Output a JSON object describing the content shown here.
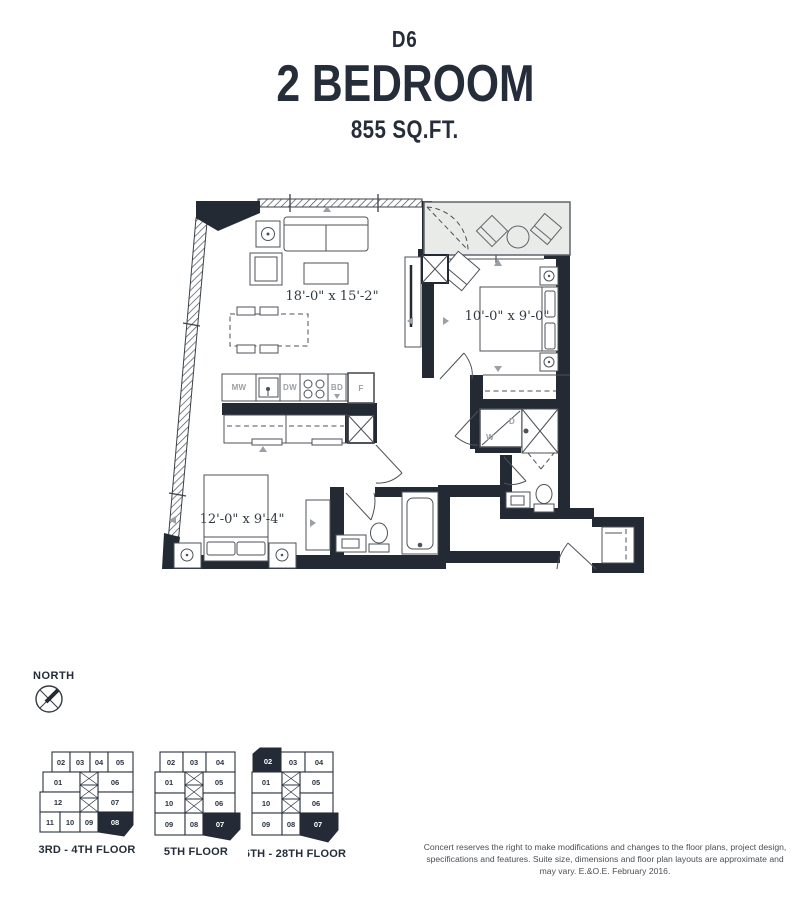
{
  "header": {
    "unit_code": "D6",
    "unit_type": "2 BEDROOM",
    "unit_size": "855 SQ.FT."
  },
  "floorplan": {
    "living_dim": "18'-0\" x 15'-2\"",
    "bedroom2_dim": "10'-0\" x 9'-0\"",
    "master_dim": "12'-0\" x 9'-4\"",
    "labels": {
      "microwave": "MW",
      "dishwasher": "DW",
      "burners": "BD",
      "fridge": "F",
      "washer": "W",
      "dryer": "D"
    }
  },
  "north": {
    "label": "NORTH"
  },
  "keyplans": [
    {
      "label": "3RD - 4TH FLOOR",
      "highlighted": "08",
      "cells": [
        "02",
        "03",
        "04",
        "05",
        "01",
        "06",
        "12",
        "07",
        "11",
        "10",
        "09",
        "08"
      ]
    },
    {
      "label": "5TH FLOOR",
      "highlighted": "07",
      "cells": [
        "02",
        "03",
        "04",
        "01",
        "05",
        "10",
        "06",
        "09",
        "08",
        "07"
      ]
    },
    {
      "label": "6TH - 28TH FLOOR",
      "highlighted": "02, 07",
      "cells": [
        "02",
        "03",
        "04",
        "01",
        "05",
        "10",
        "06",
        "09",
        "08",
        "07"
      ]
    }
  ],
  "footer": {
    "disclaimer": "Concert reserves the right to make modifications and changes to the floor plans, project design, specifications and features. Suite size, dimensions and floor plan layouts are approximate and may vary. E.&O.E. February 2016."
  }
}
